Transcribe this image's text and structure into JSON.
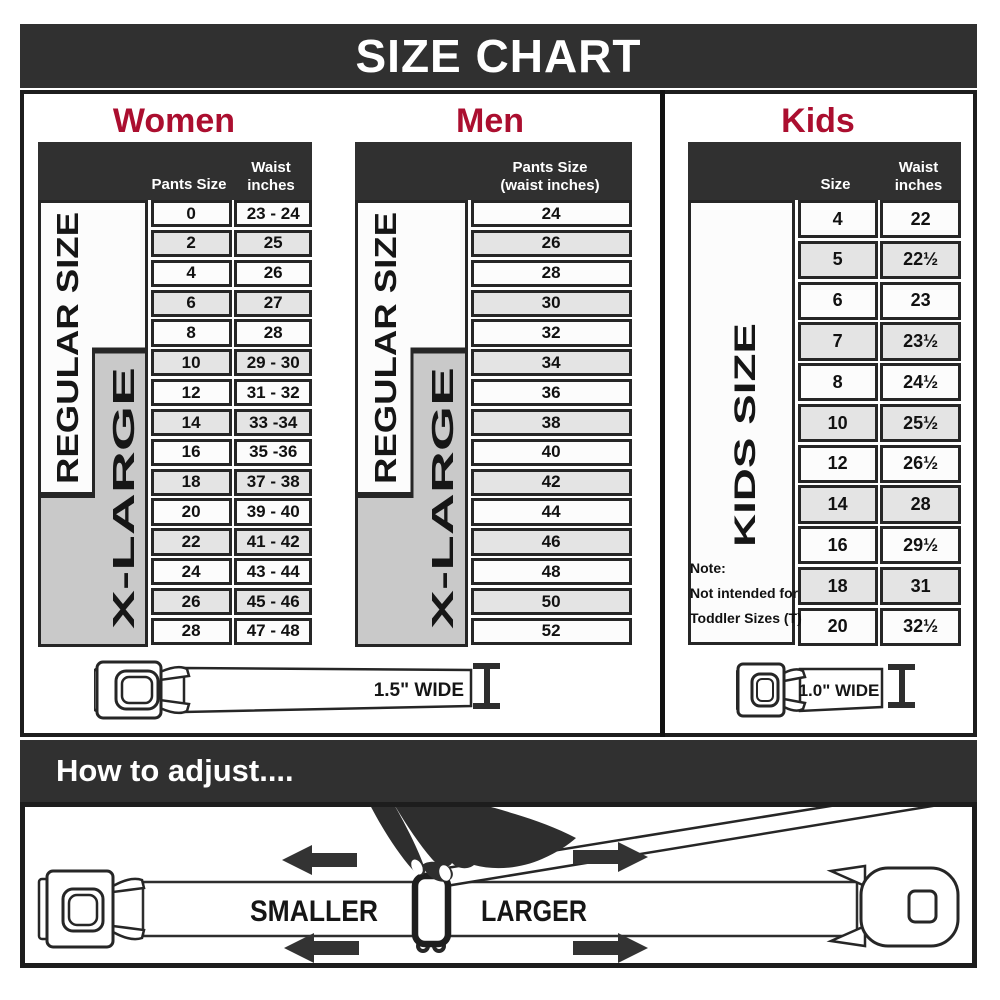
{
  "title": "SIZE CHART",
  "colors": {
    "accent_red": "#ab0e2f",
    "dark": "#303030",
    "cell_alt": "#e4e4e4",
    "xlarge_gray": "#c9c9c9"
  },
  "sections": {
    "women": {
      "heading": "Women",
      "col1_header": "Pants Size",
      "col2_header": [
        "Waist",
        "inches"
      ],
      "regular_label": "REGULAR SIZE",
      "xlarge_label": "X-LARGE",
      "rows": [
        {
          "size": "0",
          "waist": "23 - 24"
        },
        {
          "size": "2",
          "waist": "25"
        },
        {
          "size": "4",
          "waist": "26"
        },
        {
          "size": "6",
          "waist": "27"
        },
        {
          "size": "8",
          "waist": "28"
        },
        {
          "size": "10",
          "waist": "29 - 30"
        },
        {
          "size": "12",
          "waist": "31 - 32"
        },
        {
          "size": "14",
          "waist": "33 -34"
        },
        {
          "size": "16",
          "waist": "35 -36"
        },
        {
          "size": "18",
          "waist": "37 - 38"
        },
        {
          "size": "20",
          "waist": "39 - 40"
        },
        {
          "size": "22",
          "waist": "41 - 42"
        },
        {
          "size": "24",
          "waist": "43 - 44"
        },
        {
          "size": "26",
          "waist": "45 - 46"
        },
        {
          "size": "28",
          "waist": "47 - 48"
        }
      ]
    },
    "men": {
      "heading": "Men",
      "col_header": [
        "Pants Size",
        "(waist inches)"
      ],
      "regular_label": "REGULAR SIZE",
      "xlarge_label": "X-LARGE",
      "rows": [
        "24",
        "26",
        "28",
        "30",
        "32",
        "34",
        "36",
        "38",
        "40",
        "42",
        "44",
        "46",
        "48",
        "50",
        "52"
      ]
    },
    "kids": {
      "heading": "Kids",
      "col1_header": "Size",
      "col2_header": [
        "Waist",
        "inches"
      ],
      "side_label": "KIDS SIZE",
      "note": [
        "Note:",
        "Not intended for",
        "Toddler Sizes (T)"
      ],
      "rows": [
        {
          "size": "4",
          "waist": "22"
        },
        {
          "size": "5",
          "waist": "22½"
        },
        {
          "size": "6",
          "waist": "23"
        },
        {
          "size": "7",
          "waist": "23½"
        },
        {
          "size": "8",
          "waist": "24½"
        },
        {
          "size": "10",
          "waist": "25½"
        },
        {
          "size": "12",
          "waist": "26½"
        },
        {
          "size": "14",
          "waist": "28"
        },
        {
          "size": "16",
          "waist": "29½"
        },
        {
          "size": "18",
          "waist": "31"
        },
        {
          "size": "20",
          "waist": "32½"
        }
      ]
    }
  },
  "belts": {
    "adult_width_label": "1.5\" WIDE",
    "kids_width_label": "1.0\" WIDE"
  },
  "how_to_adjust": {
    "heading": "How to adjust....",
    "smaller_label": "SMALLER",
    "larger_label": "LARGER"
  },
  "chart_data": [
    {
      "type": "table",
      "title": "Women",
      "columns": [
        "Pants Size",
        "Waist inches"
      ],
      "rows": [
        [
          "0",
          "23 - 24"
        ],
        [
          "2",
          "25"
        ],
        [
          "4",
          "26"
        ],
        [
          "6",
          "27"
        ],
        [
          "8",
          "28"
        ],
        [
          "10",
          "29 - 30"
        ],
        [
          "12",
          "31 - 32"
        ],
        [
          "14",
          "33 -34"
        ],
        [
          "16",
          "35 -36"
        ],
        [
          "18",
          "37 - 38"
        ],
        [
          "20",
          "39 - 40"
        ],
        [
          "22",
          "41 - 42"
        ],
        [
          "24",
          "43 - 44"
        ],
        [
          "26",
          "45 - 46"
        ],
        [
          "28",
          "47 - 48"
        ]
      ],
      "row_groups": [
        {
          "label": "REGULAR SIZE",
          "rows": [
            "0",
            "2",
            "4",
            "6",
            "8",
            "10",
            "12",
            "14",
            "16",
            "18"
          ]
        },
        {
          "label": "X-LARGE",
          "rows": [
            "10",
            "12",
            "14",
            "16",
            "18",
            "20",
            "22",
            "24",
            "26",
            "28"
          ]
        }
      ]
    },
    {
      "type": "table",
      "title": "Men",
      "columns": [
        "Pants Size (waist inches)"
      ],
      "rows": [
        [
          "24"
        ],
        [
          "26"
        ],
        [
          "28"
        ],
        [
          "30"
        ],
        [
          "32"
        ],
        [
          "34"
        ],
        [
          "36"
        ],
        [
          "38"
        ],
        [
          "40"
        ],
        [
          "42"
        ],
        [
          "44"
        ],
        [
          "46"
        ],
        [
          "48"
        ],
        [
          "50"
        ],
        [
          "52"
        ]
      ],
      "row_groups": [
        {
          "label": "REGULAR SIZE",
          "rows": [
            "24",
            "26",
            "28",
            "30",
            "32",
            "34",
            "36",
            "38",
            "40",
            "42"
          ]
        },
        {
          "label": "X-LARGE",
          "rows": [
            "34",
            "36",
            "38",
            "40",
            "42",
            "44",
            "46",
            "48",
            "50",
            "52"
          ]
        }
      ]
    },
    {
      "type": "table",
      "title": "Kids",
      "columns": [
        "Size",
        "Waist inches"
      ],
      "rows": [
        [
          "4",
          "22"
        ],
        [
          "5",
          "22½"
        ],
        [
          "6",
          "23"
        ],
        [
          "7",
          "23½"
        ],
        [
          "8",
          "24½"
        ],
        [
          "10",
          "25½"
        ],
        [
          "12",
          "26½"
        ],
        [
          "14",
          "28"
        ],
        [
          "16",
          "29½"
        ],
        [
          "18",
          "31"
        ],
        [
          "20",
          "32½"
        ]
      ],
      "row_groups": [
        {
          "label": "KIDS SIZE",
          "rows": [
            "4",
            "5",
            "6",
            "7",
            "8",
            "10",
            "12",
            "14",
            "16",
            "18",
            "20"
          ]
        }
      ]
    }
  ]
}
